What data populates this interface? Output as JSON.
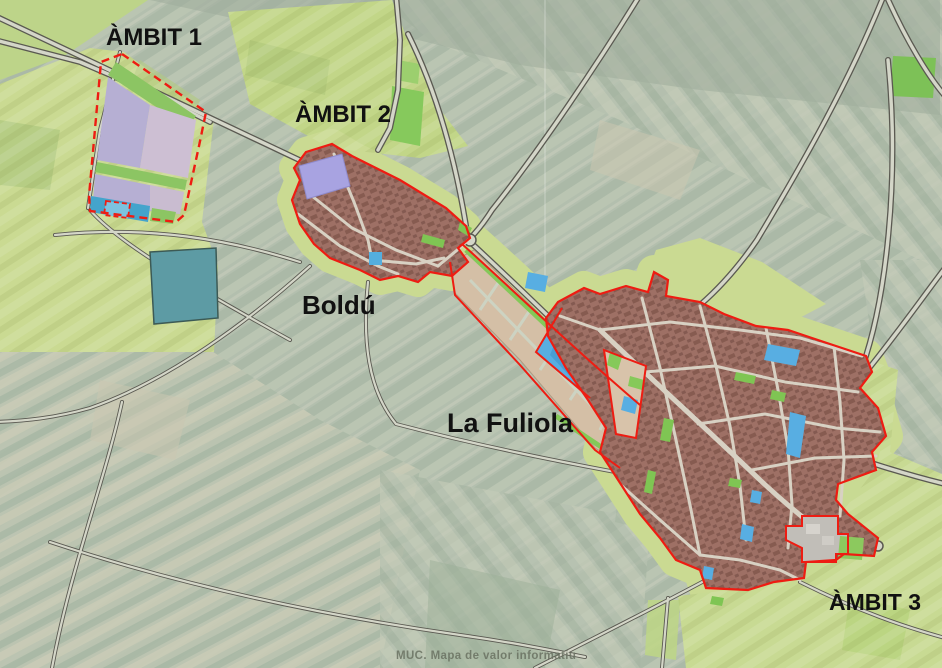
{
  "map": {
    "place_labels": [
      {
        "id": "ambit-1",
        "text": "ÀMBIT 1"
      },
      {
        "id": "ambit-2",
        "text": "ÀMBIT 2"
      },
      {
        "id": "boldu",
        "text": "Boldú"
      },
      {
        "id": "la-fuliola",
        "text": "La Fuliola"
      },
      {
        "id": "ambit-3",
        "text": "ÀMBIT 3"
      }
    ],
    "watermark": "MUC. Mapa de valor informatiu",
    "colors": {
      "boundary_red": "#ee1c12",
      "label_color": "#111111",
      "watermark_color": "#6a7262",
      "aerial_base": "#b3bfae",
      "zone_yellow_green": "#cada92",
      "zone_bright_green": "#84c858",
      "urban_fabric": "#9e7065",
      "urban_texture": "#6e463c",
      "planned_tan": "#d4bfa6",
      "industrial_lavender": "#b6afd3",
      "industrial_pink": "#cdbfd3",
      "equipment_blue": "#58aee2",
      "equipment_teal": "#5d9ba4",
      "system_gray": "#c1beb8",
      "road_casing": "#5a5951",
      "road_fill": "#d4d6c8",
      "street_fill": "#d8d1c3"
    }
  }
}
